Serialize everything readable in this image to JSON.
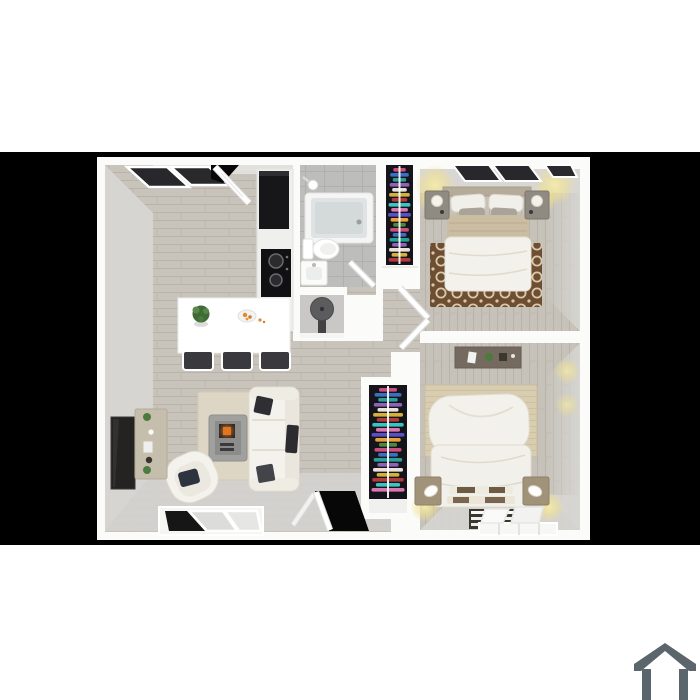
{
  "page": {
    "background": "#ffffff"
  },
  "band": {
    "color": "#000000"
  },
  "plan": {
    "wall": "#fbfbfa",
    "wall_face": "#d8d7d4",
    "wall_face_dark": "#d2d1ce",
    "wood": "#c9c4bb",
    "wood_line": "#b9b3aa",
    "tile": "#bdbdbb",
    "tile_line": "#b0b0ae",
    "counter_black": "#17171a",
    "countertop": "#efefed",
    "table_white": "#ffffff",
    "stool": "#3a3a3e",
    "tub_inner": "#dfe3e4",
    "fixture_white": "#ffffff",
    "heater": "#5c5c5e",
    "closet_bg": "#14141a",
    "rod": "#ffffff",
    "glow": "#f6ecaa",
    "rug1_base": "#6e4e32",
    "rug1_pattern": "#d9c9ab",
    "rug2_beige": "#d8cdb0",
    "rug_living": "#ded6c4",
    "sofa": "#f4f2ed",
    "pillow_dark": "#2e2e33",
    "coffee_table": "#a0a09e",
    "fire_orange": "#e0761f",
    "tv": "#242321",
    "console_tan": "#c6beac",
    "desk": "#746a60",
    "bed_white": "#f3f1ec",
    "blanket_tan": "#cbbda1",
    "nightstand1": "#8f8a82",
    "nightstand2": "#a1937a",
    "window_glass": "#28282c",
    "door_black": "#070707"
  },
  "closets": {
    "clothes_colors": [
      "#c94f7c",
      "#3a6fc4",
      "#2aa198",
      "#8e62b5",
      "#e8e2da",
      "#d4b23a",
      "#b23a3a",
      "#3ac4c4",
      "#d977b0",
      "#5a4fc9",
      "#e8a23a",
      "#4a8a3a"
    ]
  },
  "house_icon": {
    "color": "#5b656c"
  }
}
